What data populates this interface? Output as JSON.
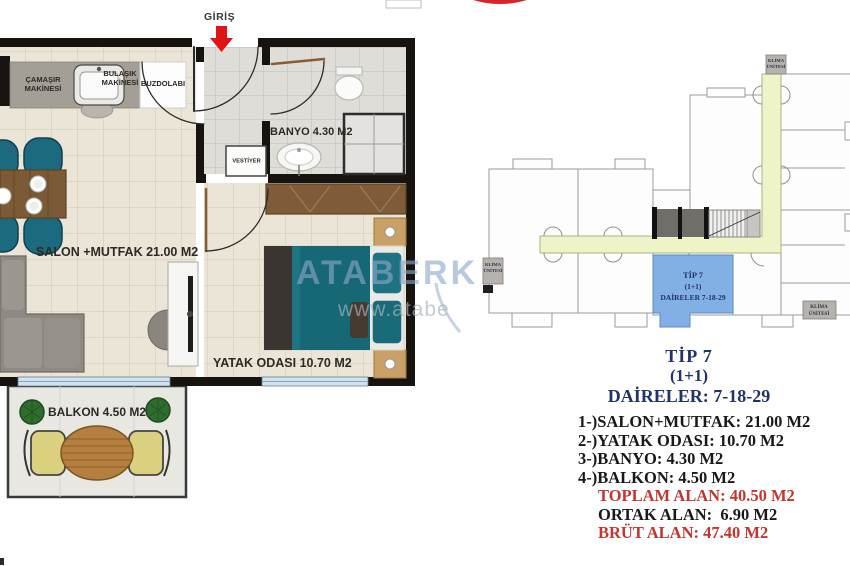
{
  "floor_plan": {
    "entrance_label": "GİRİŞ",
    "rooms": {
      "living": "SALON +MUTFAK 21.00 M2",
      "bedroom": "YATAK ODASI 10.70 M2",
      "bathroom": "BANYO 4.30 M2",
      "balcony": "BALKON 4.50 M2"
    },
    "fixtures": {
      "washer_line1": "ÇAMAŞIR",
      "washer_line2": "MAKİNESİ",
      "dishwasher_line1": "BULAŞIK",
      "dishwasher_line2": "MAKİNESİ",
      "fridge": "BUZDOLABI",
      "closet": "VESTİYER"
    },
    "watermark_line1": "ATABERK",
    "watermark_line2": "www.atabe"
  },
  "key_plan": {
    "highlighted_unit": {
      "line1": "TİP 7",
      "line2": "(1+1)",
      "line3": "DAİRELER 7-18-29"
    },
    "ac_unit_line1": "KLİMA",
    "ac_unit_line2": "ÜNİTESİ"
  },
  "details": {
    "title": "TİP 7",
    "plan_type": "(1+1)",
    "apartments": "DAİRELER: 7-18-29",
    "rooms": [
      "1-)SALON+MUTFAK: 21.00 M2",
      "2-)YATAK ODASI: 10.70 M2",
      "3-)BANYO: 4.30 M2",
      "4-)BALKON: 4.50 M2"
    ],
    "total_area": "TOPLAM ALAN: 40.50 M2",
    "common_area": "ORTAK ALAN:  6.90 M2",
    "gross_area": "BRÜT ALAN: 47.40 M2"
  },
  "colors": {
    "accent_red": "#c6342f",
    "heading_navy": "#213369",
    "unit_highlight_blue": "#83b0e4",
    "corridor_yellow": "#eff3c8",
    "entrance_arrow_red": "#e01414"
  }
}
